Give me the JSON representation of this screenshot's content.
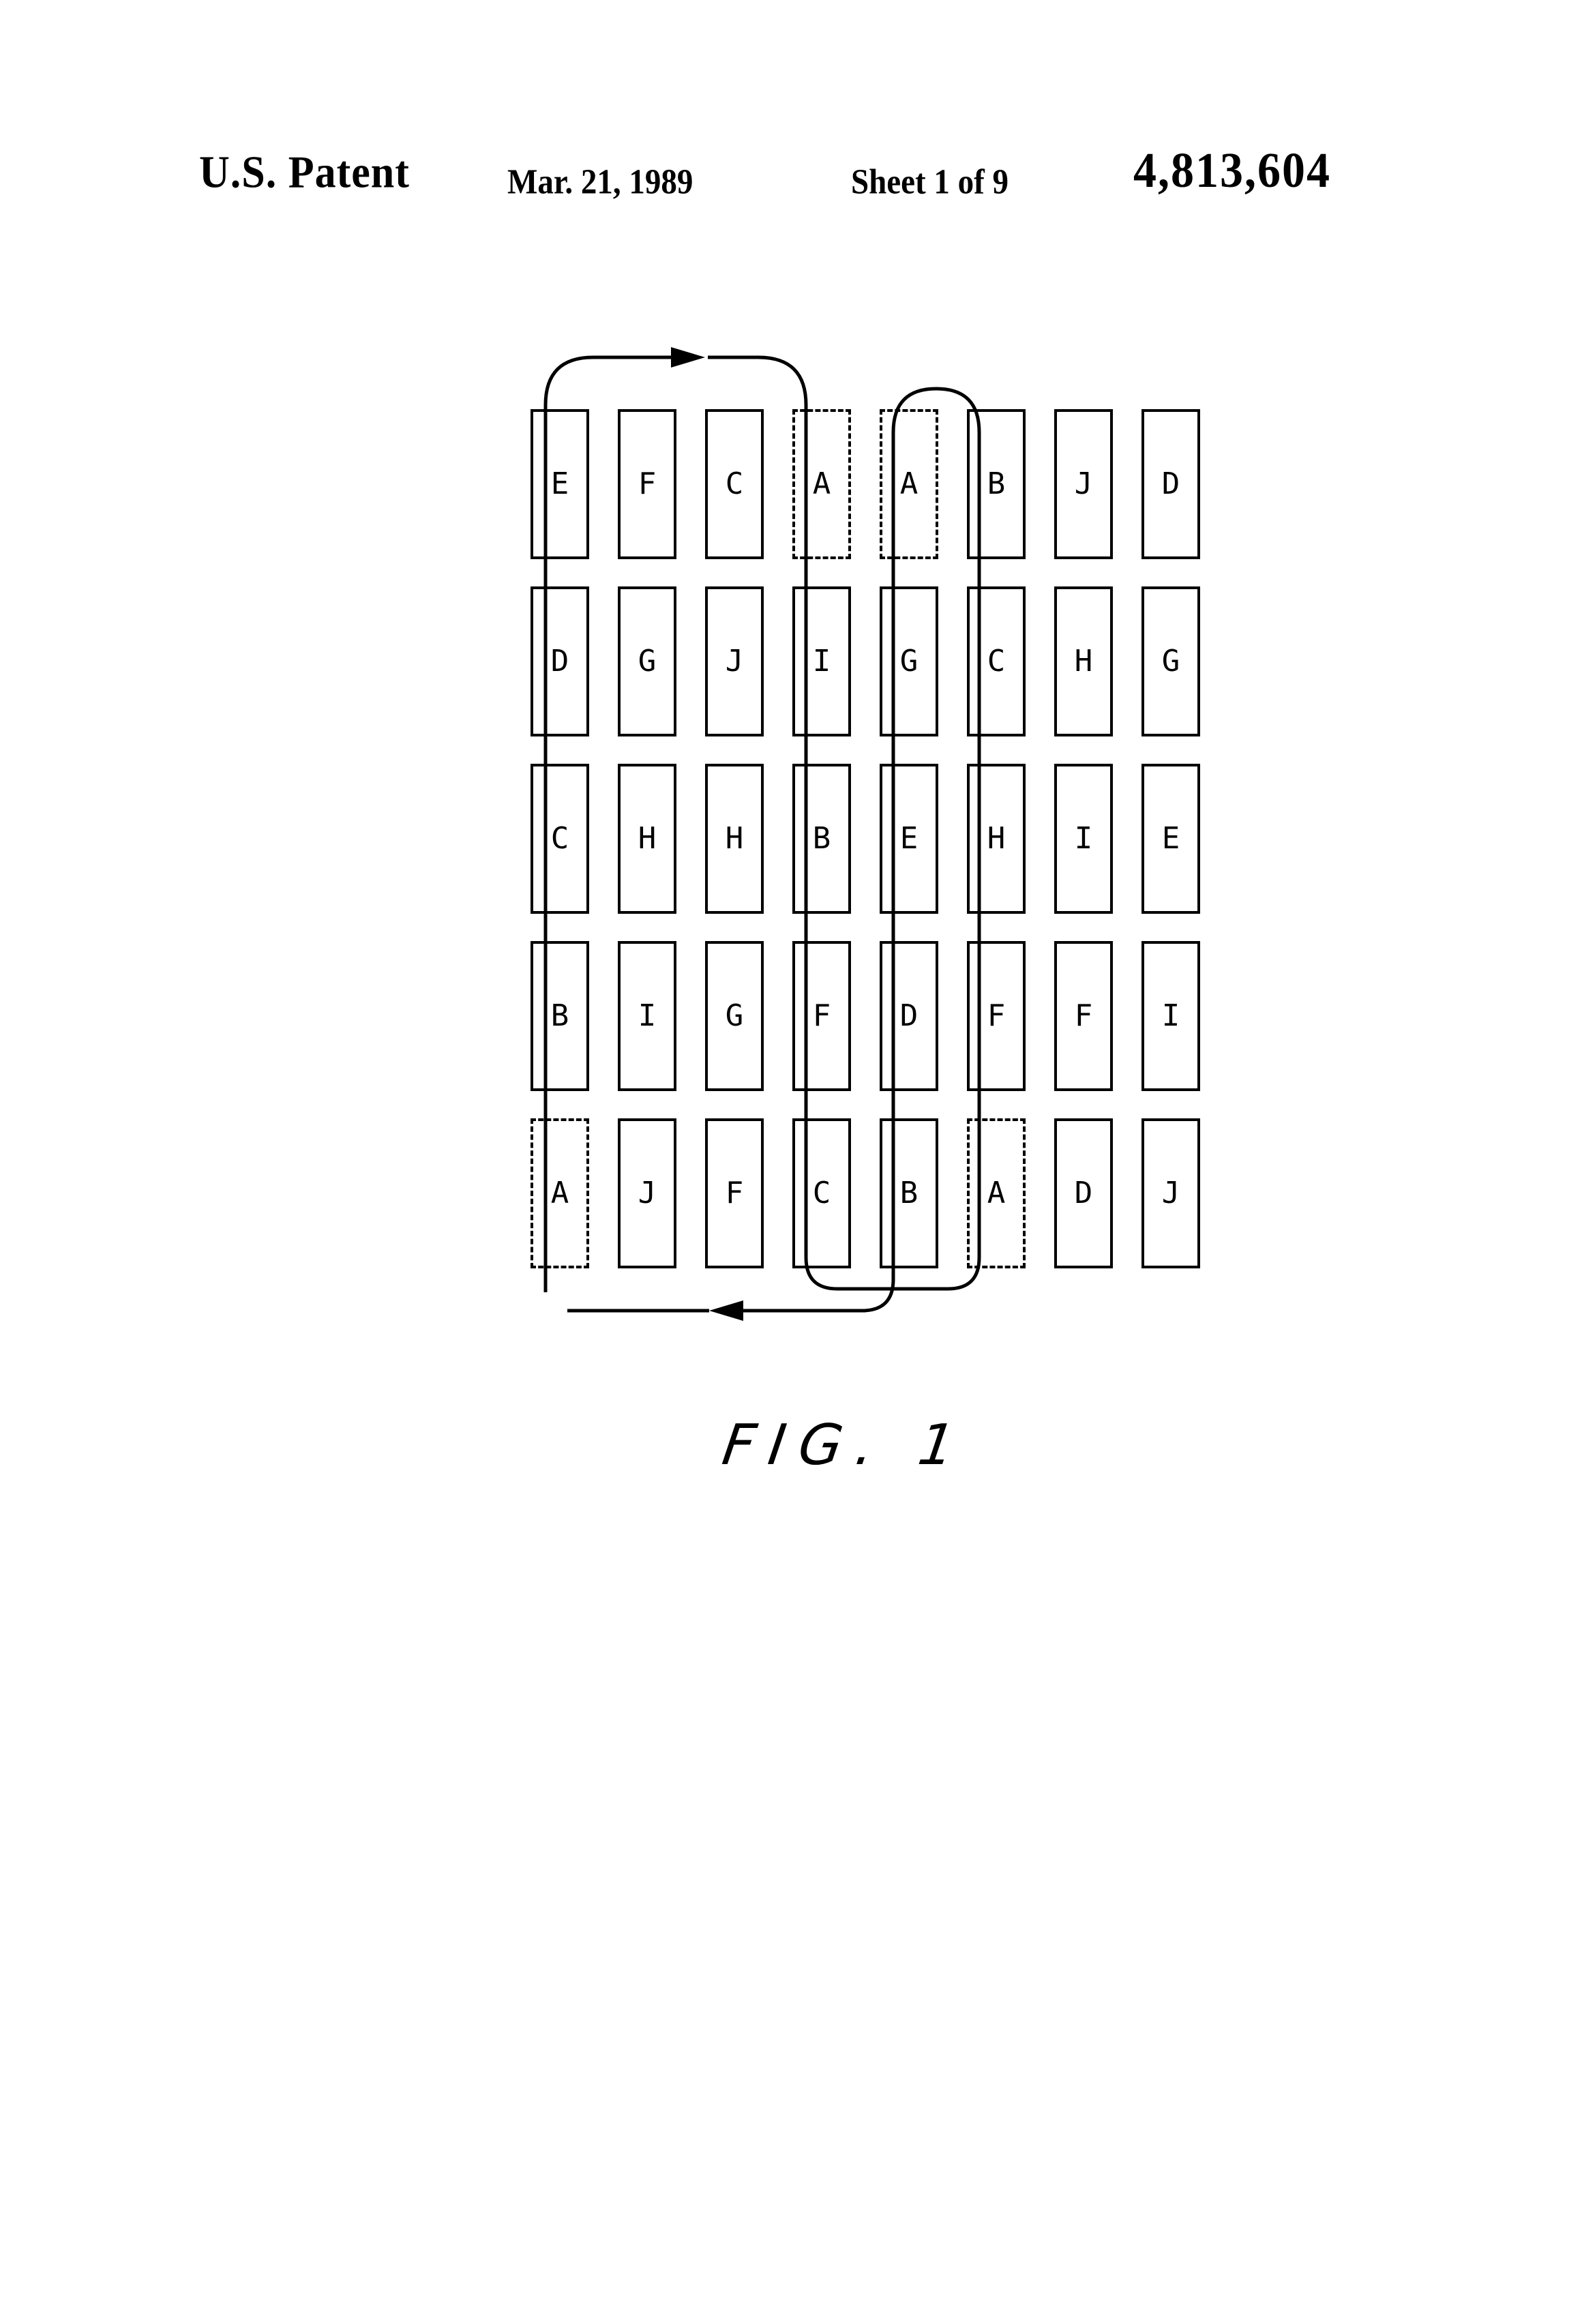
{
  "header": {
    "publication": "U.S. Patent",
    "date": "Mar. 21, 1989",
    "sheet": "Sheet 1 of 9",
    "patent_number": "4,813,604"
  },
  "figure": {
    "label": "FIG. 1",
    "colors": {
      "ink": "#000000",
      "paper": "#ffffff"
    },
    "flow": {
      "top_arrow_direction": "right",
      "bottom_arrow_direction": "left"
    },
    "grid": {
      "rows": 5,
      "cols": 8,
      "cards": [
        {
          "letter": "E",
          "dashed": false
        },
        {
          "letter": "F",
          "dashed": false
        },
        {
          "letter": "C",
          "dashed": false
        },
        {
          "letter": "A",
          "dashed": true
        },
        {
          "letter": "A",
          "dashed": true
        },
        {
          "letter": "B",
          "dashed": false
        },
        {
          "letter": "J",
          "dashed": false
        },
        {
          "letter": "D",
          "dashed": false
        },
        {
          "letter": "D",
          "dashed": false
        },
        {
          "letter": "G",
          "dashed": false
        },
        {
          "letter": "J",
          "dashed": false
        },
        {
          "letter": "I",
          "dashed": false
        },
        {
          "letter": "G",
          "dashed": false
        },
        {
          "letter": "C",
          "dashed": false
        },
        {
          "letter": "H",
          "dashed": false
        },
        {
          "letter": "G",
          "dashed": false
        },
        {
          "letter": "C",
          "dashed": false
        },
        {
          "letter": "H",
          "dashed": false
        },
        {
          "letter": "H",
          "dashed": false
        },
        {
          "letter": "B",
          "dashed": false
        },
        {
          "letter": "E",
          "dashed": false
        },
        {
          "letter": "H",
          "dashed": false
        },
        {
          "letter": "I",
          "dashed": false
        },
        {
          "letter": "E",
          "dashed": false
        },
        {
          "letter": "B",
          "dashed": false
        },
        {
          "letter": "I",
          "dashed": false
        },
        {
          "letter": "G",
          "dashed": false
        },
        {
          "letter": "F",
          "dashed": false
        },
        {
          "letter": "D",
          "dashed": false
        },
        {
          "letter": "F",
          "dashed": false
        },
        {
          "letter": "F",
          "dashed": false
        },
        {
          "letter": "I",
          "dashed": false
        },
        {
          "letter": "A",
          "dashed": true
        },
        {
          "letter": "J",
          "dashed": false
        },
        {
          "letter": "F",
          "dashed": false
        },
        {
          "letter": "C",
          "dashed": false
        },
        {
          "letter": "B",
          "dashed": false
        },
        {
          "letter": "A",
          "dashed": true
        },
        {
          "letter": "D",
          "dashed": false
        },
        {
          "letter": "J",
          "dashed": false
        }
      ]
    }
  }
}
